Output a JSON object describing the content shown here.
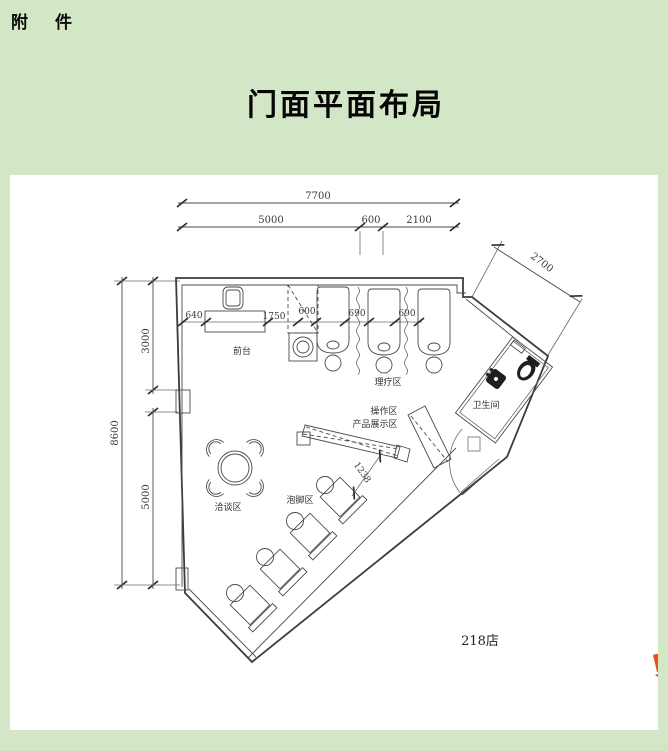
{
  "page": {
    "attachment_label": "附　件",
    "title": "门面平面布局",
    "store_label": "218店"
  },
  "colors": {
    "background_green": "#d3e6c6",
    "panel_white": "#ffffff",
    "line_dark": "#3c3c3c",
    "brand_orange": "#e8520f"
  },
  "plan": {
    "dims": {
      "total_width": "7700",
      "left_width": "5000",
      "mid_width": "600",
      "right_width": "2100",
      "diagonal": "2700",
      "total_height": "8600",
      "upper_height": "3000",
      "lower_height": "5000",
      "desk_offset": "640",
      "desk_length": "1750",
      "closet_width": "600",
      "bed_gap_1": "690",
      "bed_gap_2": "690",
      "display_length": "1238"
    },
    "areas": {
      "front_desk": "前台",
      "therapy": "理疗区",
      "restroom": "卫生间",
      "operation": "操作区",
      "display": "产品展示区",
      "foot_bath": "泡脚区",
      "negotiation": "洽谈区"
    }
  }
}
